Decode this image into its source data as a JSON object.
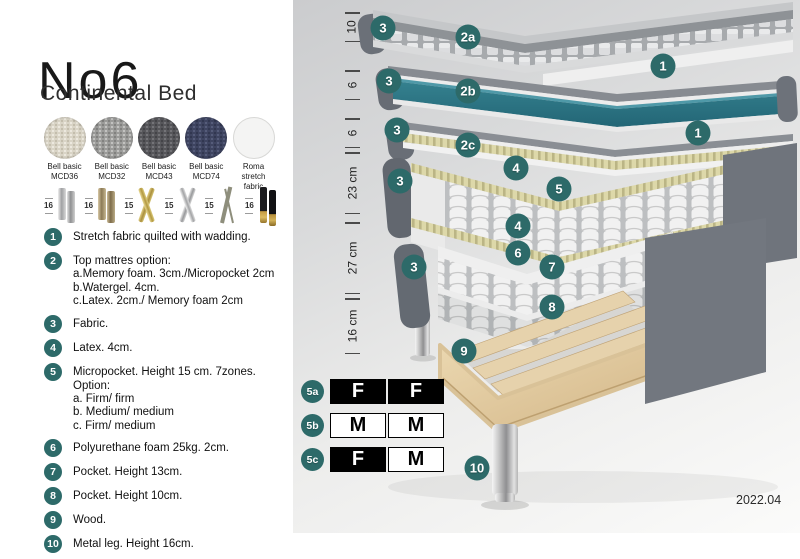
{
  "header": {
    "title": "No6",
    "subtitle": "Continental Bed"
  },
  "swatches": [
    {
      "line1": "Bell basic",
      "line2": "MCD36"
    },
    {
      "line1": "Bell basic",
      "line2": "MCD32"
    },
    {
      "line1": "Bell basic",
      "line2": "MCD43"
    },
    {
      "line1": "Bell basic",
      "line2": "MCD74"
    },
    {
      "line1": "Roma",
      "line2": "stretch fabric"
    }
  ],
  "legs": [
    {
      "size": "16",
      "type": "cylinder-silver"
    },
    {
      "size": "16",
      "type": "cylinder-bronze"
    },
    {
      "size": "15",
      "type": "cross-gold"
    },
    {
      "size": "15",
      "type": "cross-silver"
    },
    {
      "size": "15",
      "type": "hairpin"
    },
    {
      "size": "16",
      "type": "cylinder-black-gold"
    }
  ],
  "legend": {
    "items": [
      {
        "num": "1",
        "text": "Stretch fabric quilted with wadding."
      },
      {
        "num": "2",
        "text": "Top mattres option:",
        "options": [
          "a.Memory foam. 3cm./Micropocket 2cm",
          "b.Watergel. 4cm.",
          "c.Latex. 2cm./ Memory foam 2cm"
        ]
      },
      {
        "num": "3",
        "text": "Fabric."
      },
      {
        "num": "4",
        "text": "Latex. 4cm."
      },
      {
        "num": "5",
        "text": "Micropocket. Height 15 cm. 7zones. Option:",
        "options": [
          "a. Firm/ firm",
          "b. Medium/ medium",
          "c. Firm/ medium"
        ]
      },
      {
        "num": "6",
        "text": "Polyurethane foam 25kg. 2cm."
      },
      {
        "num": "7",
        "text": "Pocket. Height 13cm."
      },
      {
        "num": "8",
        "text": "Pocket. Height 10cm."
      },
      {
        "num": "9",
        "text": "Wood."
      },
      {
        "num": "10",
        "text": "Metal leg. Height 16cm."
      }
    ]
  },
  "diagram": {
    "measurements": [
      "10",
      "6",
      "6",
      "23 cm",
      "27 cm",
      "16 cm"
    ],
    "markers": [
      "3",
      "2a",
      "1",
      "3",
      "2b",
      "3",
      "2c",
      "1",
      "4",
      "5",
      "3",
      "4",
      "6",
      "7",
      "3",
      "8",
      "9",
      "10"
    ],
    "colors": {
      "marker_teal": "#2d6a69",
      "watergel_teal": "#2b7686",
      "latex_khaki": "#ddd8a9",
      "wood_tan": "#dfc8a0",
      "fabric_gray": "#6d727a"
    }
  },
  "firmness": {
    "rows": [
      {
        "label": "5a",
        "cells": [
          {
            "text": "F",
            "filled": true
          },
          {
            "text": "F",
            "filled": true
          }
        ]
      },
      {
        "label": "5b",
        "cells": [
          {
            "text": "M",
            "filled": false
          },
          {
            "text": "M",
            "filled": false
          }
        ]
      },
      {
        "label": "5c",
        "cells": [
          {
            "text": "F",
            "filled": true
          },
          {
            "text": "M",
            "filled": false
          }
        ]
      }
    ]
  },
  "footer": {
    "version": "2022.04"
  }
}
